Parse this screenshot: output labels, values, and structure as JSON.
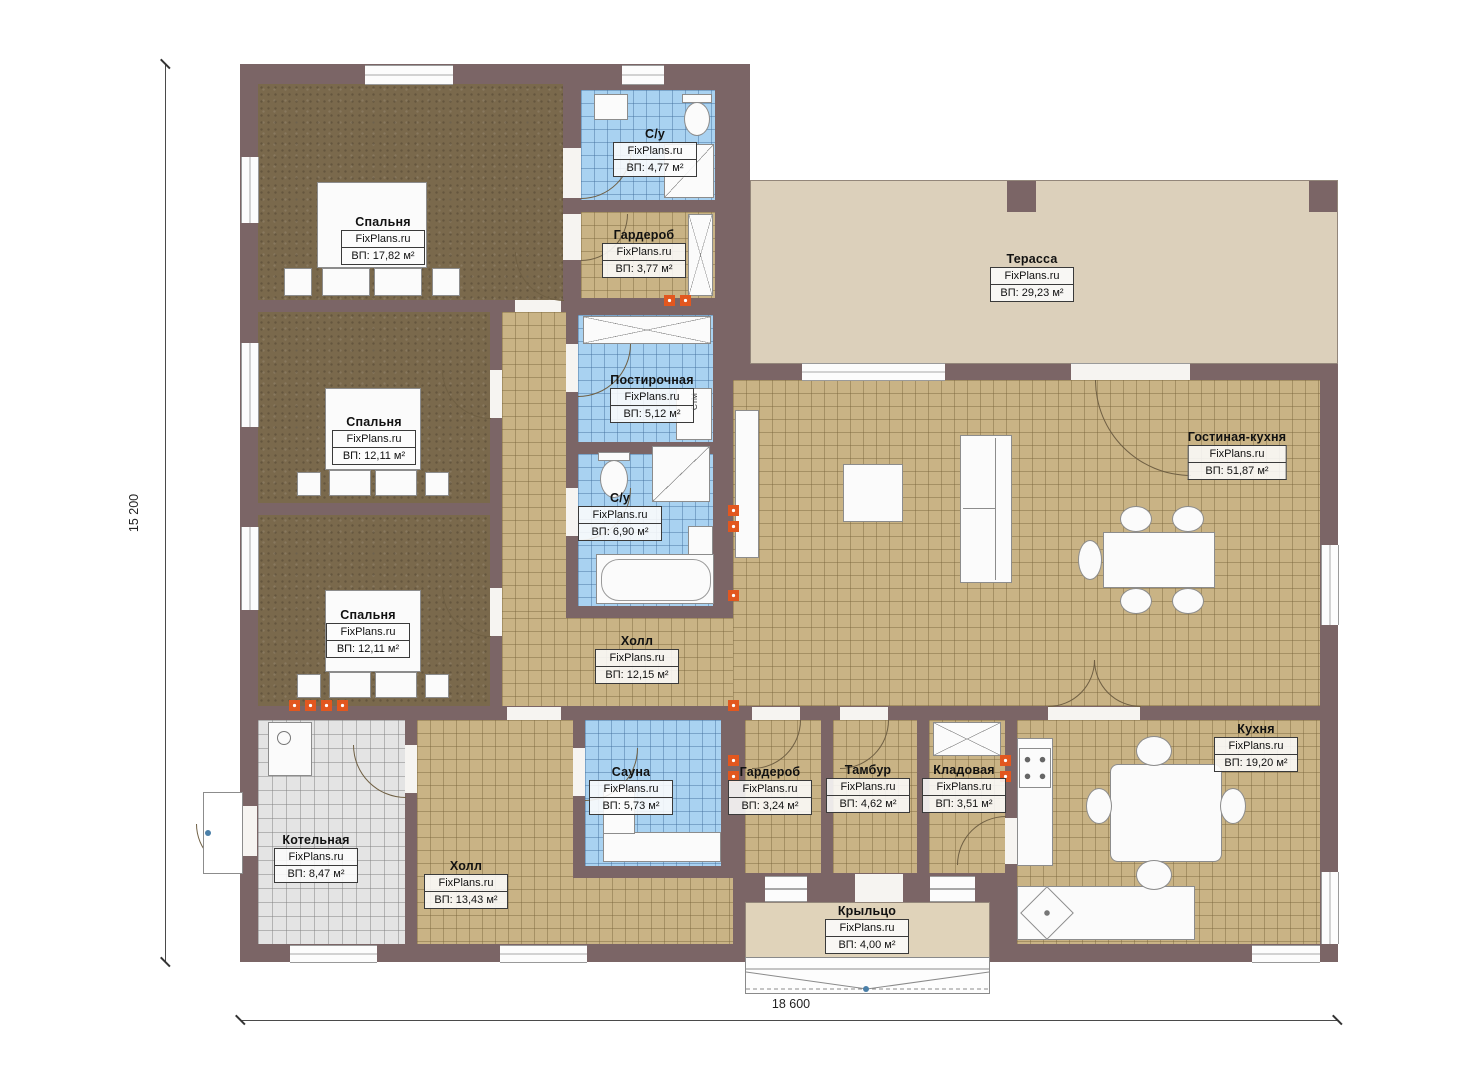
{
  "brand": "FixPlans.ru",
  "dimensions": {
    "height_label": "15 200",
    "width_label": "18 600"
  },
  "appliances": {
    "washer": "СтМ"
  },
  "colors": {
    "wall": "#7b6566",
    "floor_tan": "#c9b385",
    "floor_blue": "#a9d2f1",
    "floor_brown": "#7a694c",
    "floor_gray": "#e4e4e4",
    "terrace": "#dcd0bb",
    "porch": "#e0d3ba",
    "vent_marker": "#e2571f"
  },
  "rooms": [
    {
      "name": "Спальня",
      "area": "ВП: 17,82 м²"
    },
    {
      "name": "С/у",
      "area": "ВП: 4,77 м²"
    },
    {
      "name": "Гардероб",
      "area": "ВП: 3,77 м²"
    },
    {
      "name": "Спальня",
      "area": "ВП: 12,11 м²"
    },
    {
      "name": "Постирочная",
      "area": "ВП: 5,12 м²"
    },
    {
      "name": "С/у",
      "area": "ВП: 6,90 м²"
    },
    {
      "name": "Спальня",
      "area": "ВП: 12,11 м²"
    },
    {
      "name": "Холл",
      "area": "ВП: 12,15 м²"
    },
    {
      "name": "Терасса",
      "area": "ВП: 29,23 м²"
    },
    {
      "name": "Гостиная-кухня",
      "area": "ВП: 51,87 м²"
    },
    {
      "name": "Котельная",
      "area": "ВП: 8,47 м²"
    },
    {
      "name": "Холл",
      "area": "ВП: 13,43 м²"
    },
    {
      "name": "Сауна",
      "area": "ВП: 5,73 м²"
    },
    {
      "name": "Гардероб",
      "area": "ВП: 3,24 м²"
    },
    {
      "name": "Тамбур",
      "area": "ВП: 4,62 м²"
    },
    {
      "name": "Кладовая",
      "area": "ВП: 3,51 м²"
    },
    {
      "name": "Кухня",
      "area": "ВП: 19,20 м²"
    },
    {
      "name": "Крыльцо",
      "area": "ВП: 4,00 м²"
    }
  ]
}
